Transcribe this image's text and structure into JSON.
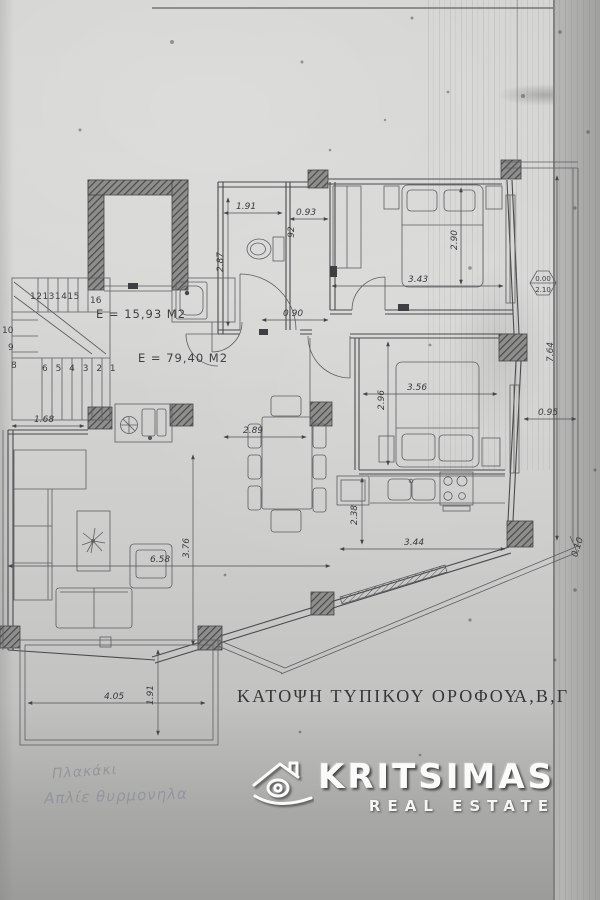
{
  "plan": {
    "title": {
      "main": "ΚΑΤΟΨΗ ΤΥΠΙΚΟΥ ΟΡΟΦΟΥ",
      "suffix": "Α,Β,Γ"
    },
    "areas": {
      "stair": "E = 15,93 M2",
      "apartment": "E = 79,40 M2"
    },
    "level": {
      "top": "0.00",
      "bottom": "2.10"
    },
    "dims": {
      "wc_width": "1.91",
      "wc_height": "2.87",
      "hall_width": "0.93",
      "hall_small": "92",
      "corridor": "0.90",
      "bed1_width": "3.43",
      "bed1_depth": "2.90",
      "bed2_width": "3.56",
      "bed2_depth": "2.96",
      "right_len": "7.64",
      "right_wid": "0.95",
      "edge": "0.10",
      "stair_width": "1.68",
      "dining_width": "2.89",
      "kitchen_depth": "2.38",
      "kitchen_width": "3.44",
      "living_depth": "3.76",
      "living_width": "6.58",
      "balc_w": "4.05",
      "balc_d": "1.91"
    },
    "stairs": {
      "upper": "12131415",
      "landing": "16",
      "left": [
        "10",
        "9",
        "8"
      ],
      "lower": "6 5 4 3 2 1"
    },
    "notes": [
      "Πλακάκι",
      "Απλίε θυρμονηλα"
    ]
  },
  "watermark": {
    "brand": "KRITSIMAS",
    "tagline": "REAL ESTATE",
    "icon": "house-eye-icon"
  },
  "colors": {
    "paper": "#d2d2d0",
    "ink": "#4b4b4f",
    "pencil": "#8e929c",
    "logo": "#fbfbfa"
  }
}
